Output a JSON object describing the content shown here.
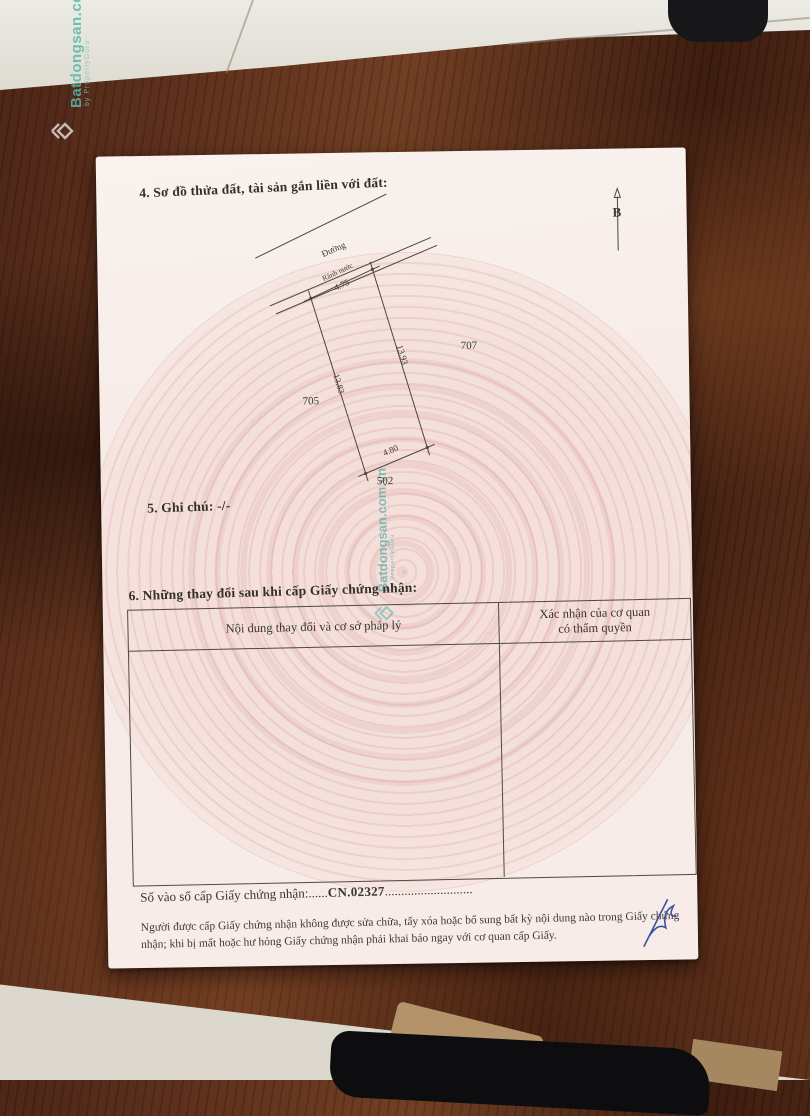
{
  "watermark": {
    "brand": "Batdongsan.com.vn",
    "sub": "by PropertyGuru"
  },
  "paper": {
    "section4_title": "4. Sơ đồ thửa đất, tài sản gắn liền với đất:",
    "section5_line": "5. Ghi chú: -/-",
    "section6_title": "6. Những thay đổi sau khi cấp Giấy chứng nhận:",
    "diagram": {
      "road_label": "Đường",
      "gutter_label": "Rãnh nước",
      "north_label": "B",
      "dim_top": "4.75",
      "dim_bottom": "4.80",
      "dim_left": "13.83",
      "dim_right": "13.93",
      "neighbor_left": "705",
      "neighbor_right": "707",
      "neighbor_bottom": "502"
    },
    "table": {
      "col1_header": "Nội dung thay đổi và cơ sở pháp lý",
      "col2_header": "Xác nhận của cơ quan\ncó thẩm quyền"
    },
    "registry": {
      "label": "Số vào sổ cấp Giấy chứng nhận:",
      "dots1": "......",
      "number": "CN.02327",
      "dots2": "..........................."
    },
    "footer_note": "Người được cấp Giấy chứng nhận không được sửa chữa, tẩy xóa hoặc bổ sung bất kỳ nội dung nào trong Giấy chứng nhận; khi bị mất hoặc hư hỏng Giấy chứng nhận phải khai báo ngay với cơ quan cấp Giấy."
  }
}
